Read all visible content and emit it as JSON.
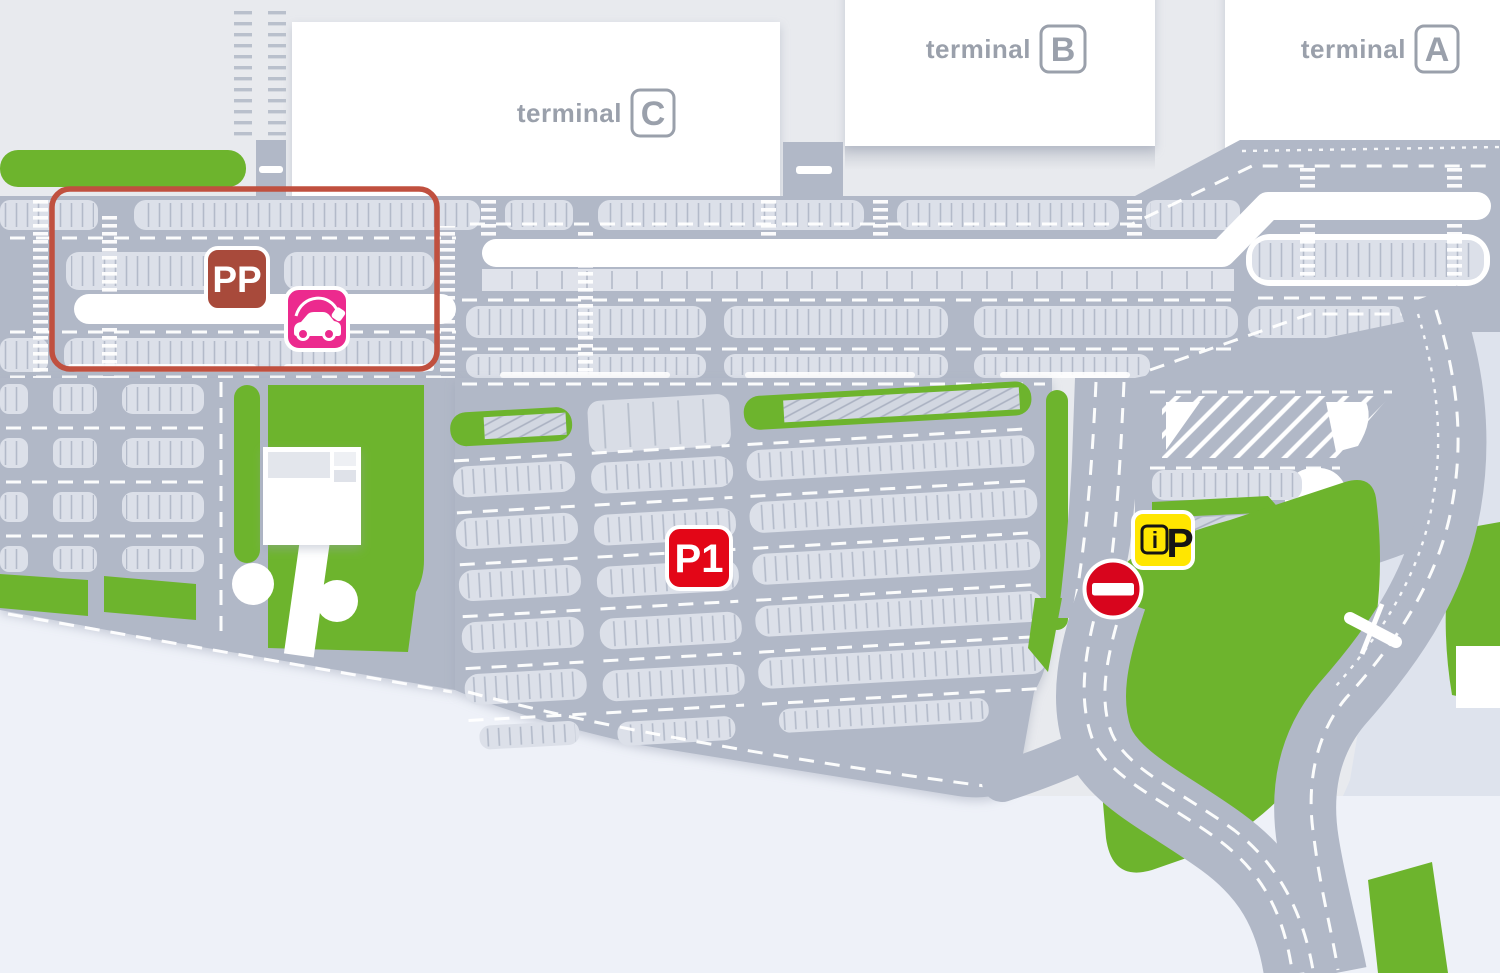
{
  "map": {
    "kind": "airport-terminal-parking-map",
    "colors": {
      "bg_upper": "#e8eaee",
      "bg_lower": "#eef1f8",
      "bg_right": "#dee3ed",
      "road": "#b1b8c7",
      "parking_row": "#dce0e9",
      "tick": "#b3bac9",
      "green": "#6db42d",
      "terminal_fill": "#ffffff",
      "terminal_text": "#9aa0ab",
      "pp_zone_outline": "#c0503f",
      "pp_badge": "#a84a3b",
      "ev_badge": "#ec2a8e",
      "p1_badge": "#e30617",
      "ip_badge": "#ffe600",
      "ip_text": "#151515",
      "no_entry": "#d8051d",
      "marking": "#ffffff"
    }
  },
  "terminals": [
    {
      "prefix": "terminal",
      "letter": "C"
    },
    {
      "prefix": "terminal",
      "letter": "B"
    },
    {
      "prefix": "terminal",
      "letter": "A"
    }
  ],
  "markers": {
    "pp": {
      "label": "PP"
    },
    "p1": {
      "label": "P1"
    },
    "ip": {
      "i": "i",
      "p": "P"
    },
    "ev": {
      "icon": "ev-charging-car-icon"
    },
    "no_entry": {
      "icon": "no-entry-icon"
    }
  }
}
